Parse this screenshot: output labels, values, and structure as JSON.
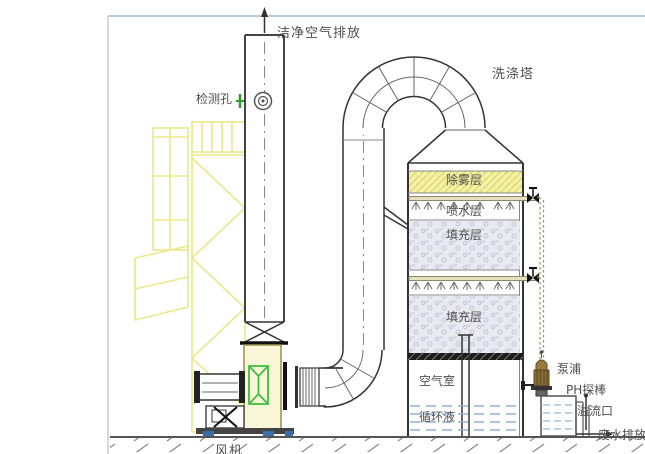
{
  "labels": {
    "clean_air_out": "洁净空气排放",
    "inspection_port": "检测孔",
    "scrubber_tower": "洗涤塔",
    "demister_layer": "除雾层",
    "spray_layer": "喷水层",
    "packing_layer_upper": "填充层",
    "packing_layer_lower": "填充层",
    "air_chamber": "空气室",
    "circulating_liquid": "循环液",
    "pump": "泵浦",
    "ph_probe": "PH探棒",
    "overflow_port": "溢流口",
    "wastewater_discharge": "废水排放",
    "fan": "风机"
  },
  "colors": {
    "frame_top_border": "#b6cde0",
    "truss_yellow": "#ebe88a",
    "demister_fill": "#f4f1a2",
    "demister_hatch": "#d8d276",
    "packing_fill": "#e9e9f2",
    "packing_speckle": "#c3c3d6",
    "water_blue": "#8fb3d9",
    "pipe_tan": "#a9945c",
    "flex_joint_green": "#3fbf3f",
    "inspection_green": "#2a9d2a",
    "base_foot_blue": "#3a6ea8",
    "line_dark": "#444444"
  }
}
